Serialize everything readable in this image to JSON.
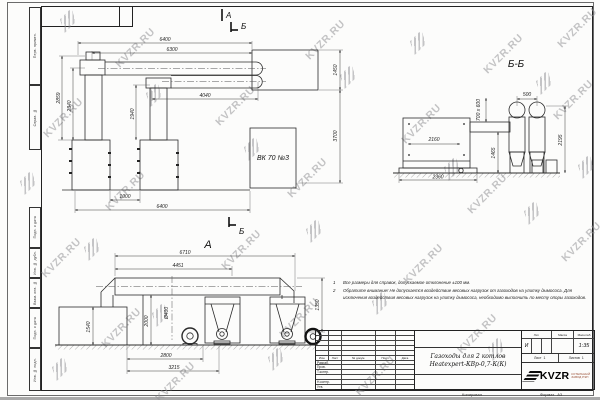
{
  "watermark": {
    "text": "KVZR.RU"
  },
  "side_strip": [
    "Перв. примен.",
    "Справ. №",
    "Подп. и дата",
    "Инв. № дубл.",
    "Взам. инв. №",
    "Подп. и дата",
    "Инв. № подл."
  ],
  "plan": {
    "marker_a": "А",
    "marker_b_top": "Б",
    "marker_b_bottom": "Б",
    "vk_label": "ВК 70 №3",
    "dims": {
      "top": "6400",
      "top2": "6300",
      "pipe": "4040",
      "h1": "2859",
      "h2": "2340",
      "h3": "1940",
      "gap": "1000",
      "bottom": "6400",
      "duct_width": "1450",
      "offset": "3700"
    }
  },
  "bb": {
    "title": "Б-Б",
    "dims": {
      "spacing": "500",
      "duct": "700 x 600",
      "boiler": "2160",
      "h_flue": "1465",
      "h_cyclone": "2195",
      "base": "2360"
    }
  },
  "va": {
    "label": "А",
    "dims": {
      "overall": "6710",
      "duct": "4451",
      "dia": "Ø400",
      "h_duct": "2000",
      "h_annex": "1540",
      "right": "1350",
      "b1": "2800",
      "b2": "3215"
    }
  },
  "notes": {
    "n1_num": "1",
    "n1": "Все размеры для справок, допускаемое отклонение ±100 мм.",
    "n2_num": "2",
    "n2": "Обратите внимание! Не допускается воздействие весовых нагрузок от газоходов на улитку дымососа. Для исключения воздействия весовых нагрузок на улитку дымососа, необходимо выполнить по месту опоры газоходов."
  },
  "title_block": {
    "rev_header": [
      "Изм.",
      "Лист",
      "№ докум.",
      "Подп.",
      "Дата"
    ],
    "role_rows": [
      "Разраб.",
      "Пров.",
      "Т.контр.",
      "",
      "Н.контр.",
      "Утв."
    ],
    "doc_title_1": "Газоходы для 2 котлов",
    "doc_title_2": "Heatexpert-КВр-0,7-К(К)",
    "lit_label": "Лит.",
    "lit_value": "И",
    "mass_label": "Масса",
    "scale_label": "Масштаб",
    "scale_value": "1:35",
    "sheet_label": "Лист",
    "sheet_value": "1",
    "sheets_label": "Листов",
    "sheets_value": "1",
    "brand": "KVZR",
    "brand_line1": "КОТЕЛЬНЫЙ",
    "brand_line2": "ЗАВОД РЭП",
    "footer_left": "Копировал",
    "footer_right": "Формат",
    "format_value": "А3"
  }
}
